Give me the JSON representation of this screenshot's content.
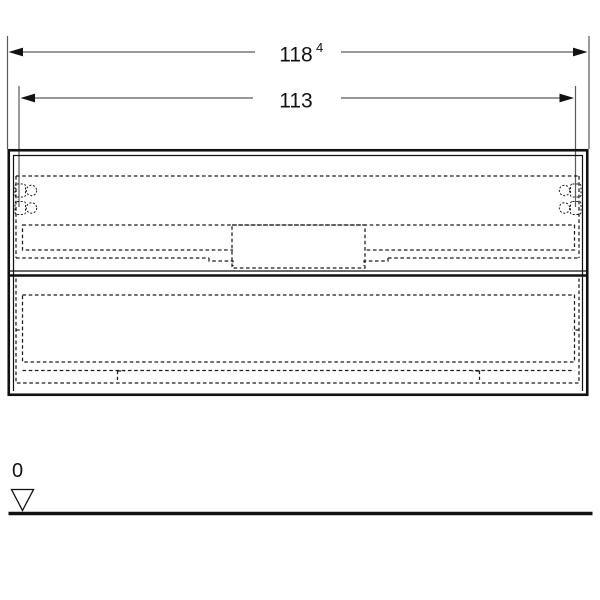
{
  "figure": {
    "kind": "furniture-front-elevation-dimension-drawing",
    "background": "#ffffff",
    "line_color": "#111111",
    "dim_line_color": "#5a5a5a"
  },
  "dimensions": {
    "overall_width": {
      "value": "118",
      "superscript": "4"
    },
    "body_width": {
      "value": "113"
    },
    "floor_level": {
      "value": "0"
    }
  },
  "icons": {
    "level_datum": "open-downward-triangle",
    "dimension_arrows": "filled-outward-arrowheads"
  }
}
